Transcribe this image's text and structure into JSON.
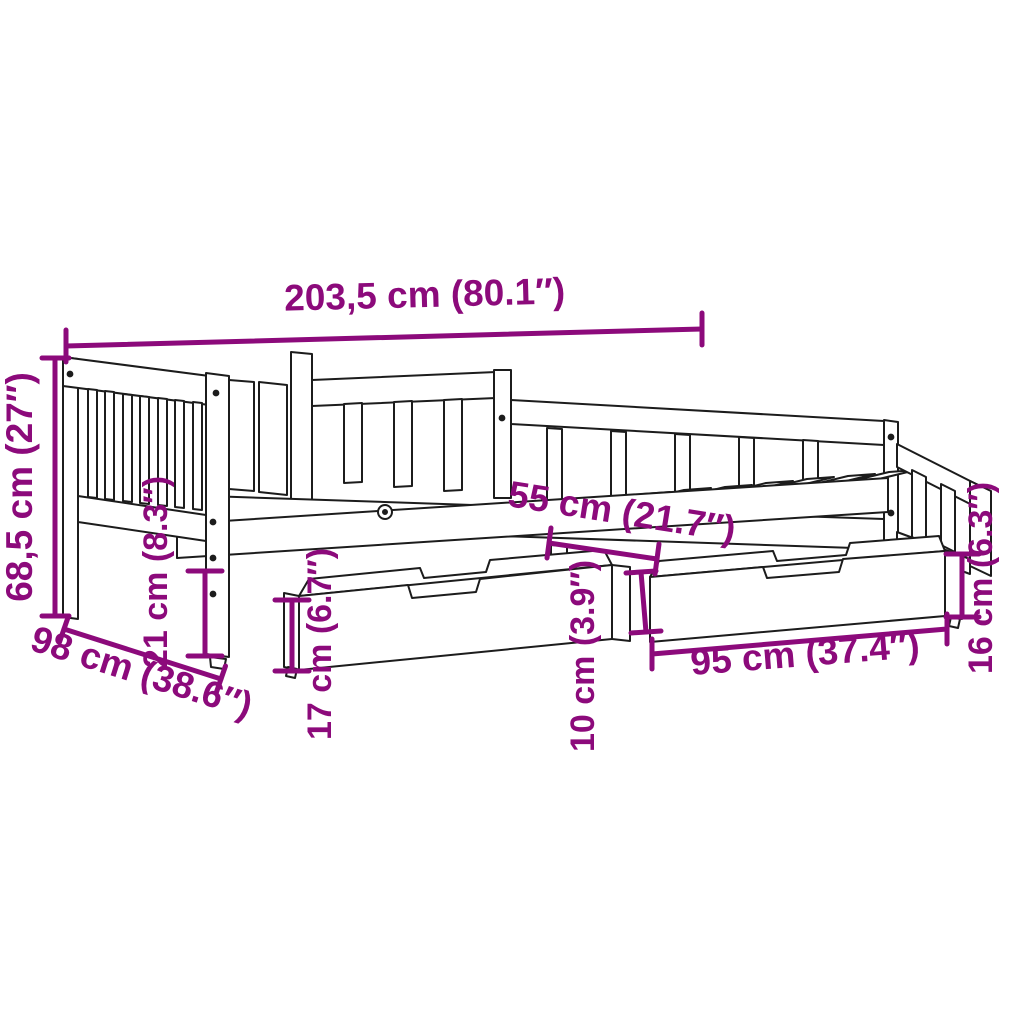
{
  "diagram": {
    "type": "product-dimension-diagram",
    "subject": "daybed with two storage drawers",
    "background_color": "#ffffff",
    "line_color": "#1c1c1c",
    "accent_color": "#8C0A7B",
    "dimensions": [
      {
        "id": "total-length",
        "label": "203,5 cm (80.1″)"
      },
      {
        "id": "total-height",
        "label": "68,5 cm (27″)"
      },
      {
        "id": "total-depth",
        "label": "98 cm (38.6″)"
      },
      {
        "id": "leg-clearance",
        "label": "21 cm (8.3″)"
      },
      {
        "id": "drawer-height",
        "label": "17 cm (6.7″)"
      },
      {
        "id": "drawer-depth",
        "label": "55 cm (21.7″)"
      },
      {
        "id": "drawer-gap-height",
        "label": "10 cm (3.9″)"
      },
      {
        "id": "drawer-width",
        "label": "95 cm (37.4″)"
      },
      {
        "id": "drawer-side-height",
        "label": "16 cm (6.3″)"
      }
    ]
  }
}
